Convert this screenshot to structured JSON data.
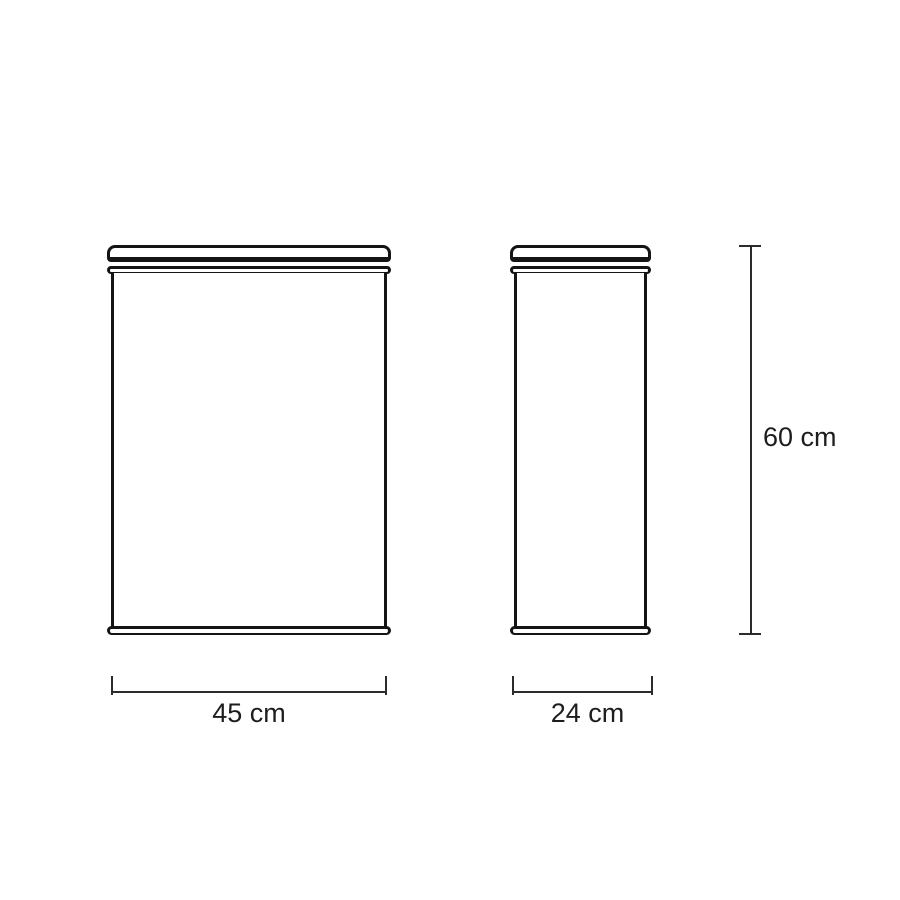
{
  "drawing": {
    "background_color": "#ffffff",
    "line_color": "#141414",
    "dimension_line_color": "#2b2b2b",
    "text_color": "#1d1d1d",
    "views": {
      "front": {
        "name": "front-view"
      },
      "side": {
        "name": "side-view"
      }
    },
    "dimensions": {
      "front_width": {
        "label": "45 cm",
        "value": 45,
        "unit": "cm"
      },
      "side_depth": {
        "label": "24 cm",
        "value": 24,
        "unit": "cm"
      },
      "height": {
        "label": "60 cm",
        "value": 60,
        "unit": "cm"
      }
    }
  }
}
